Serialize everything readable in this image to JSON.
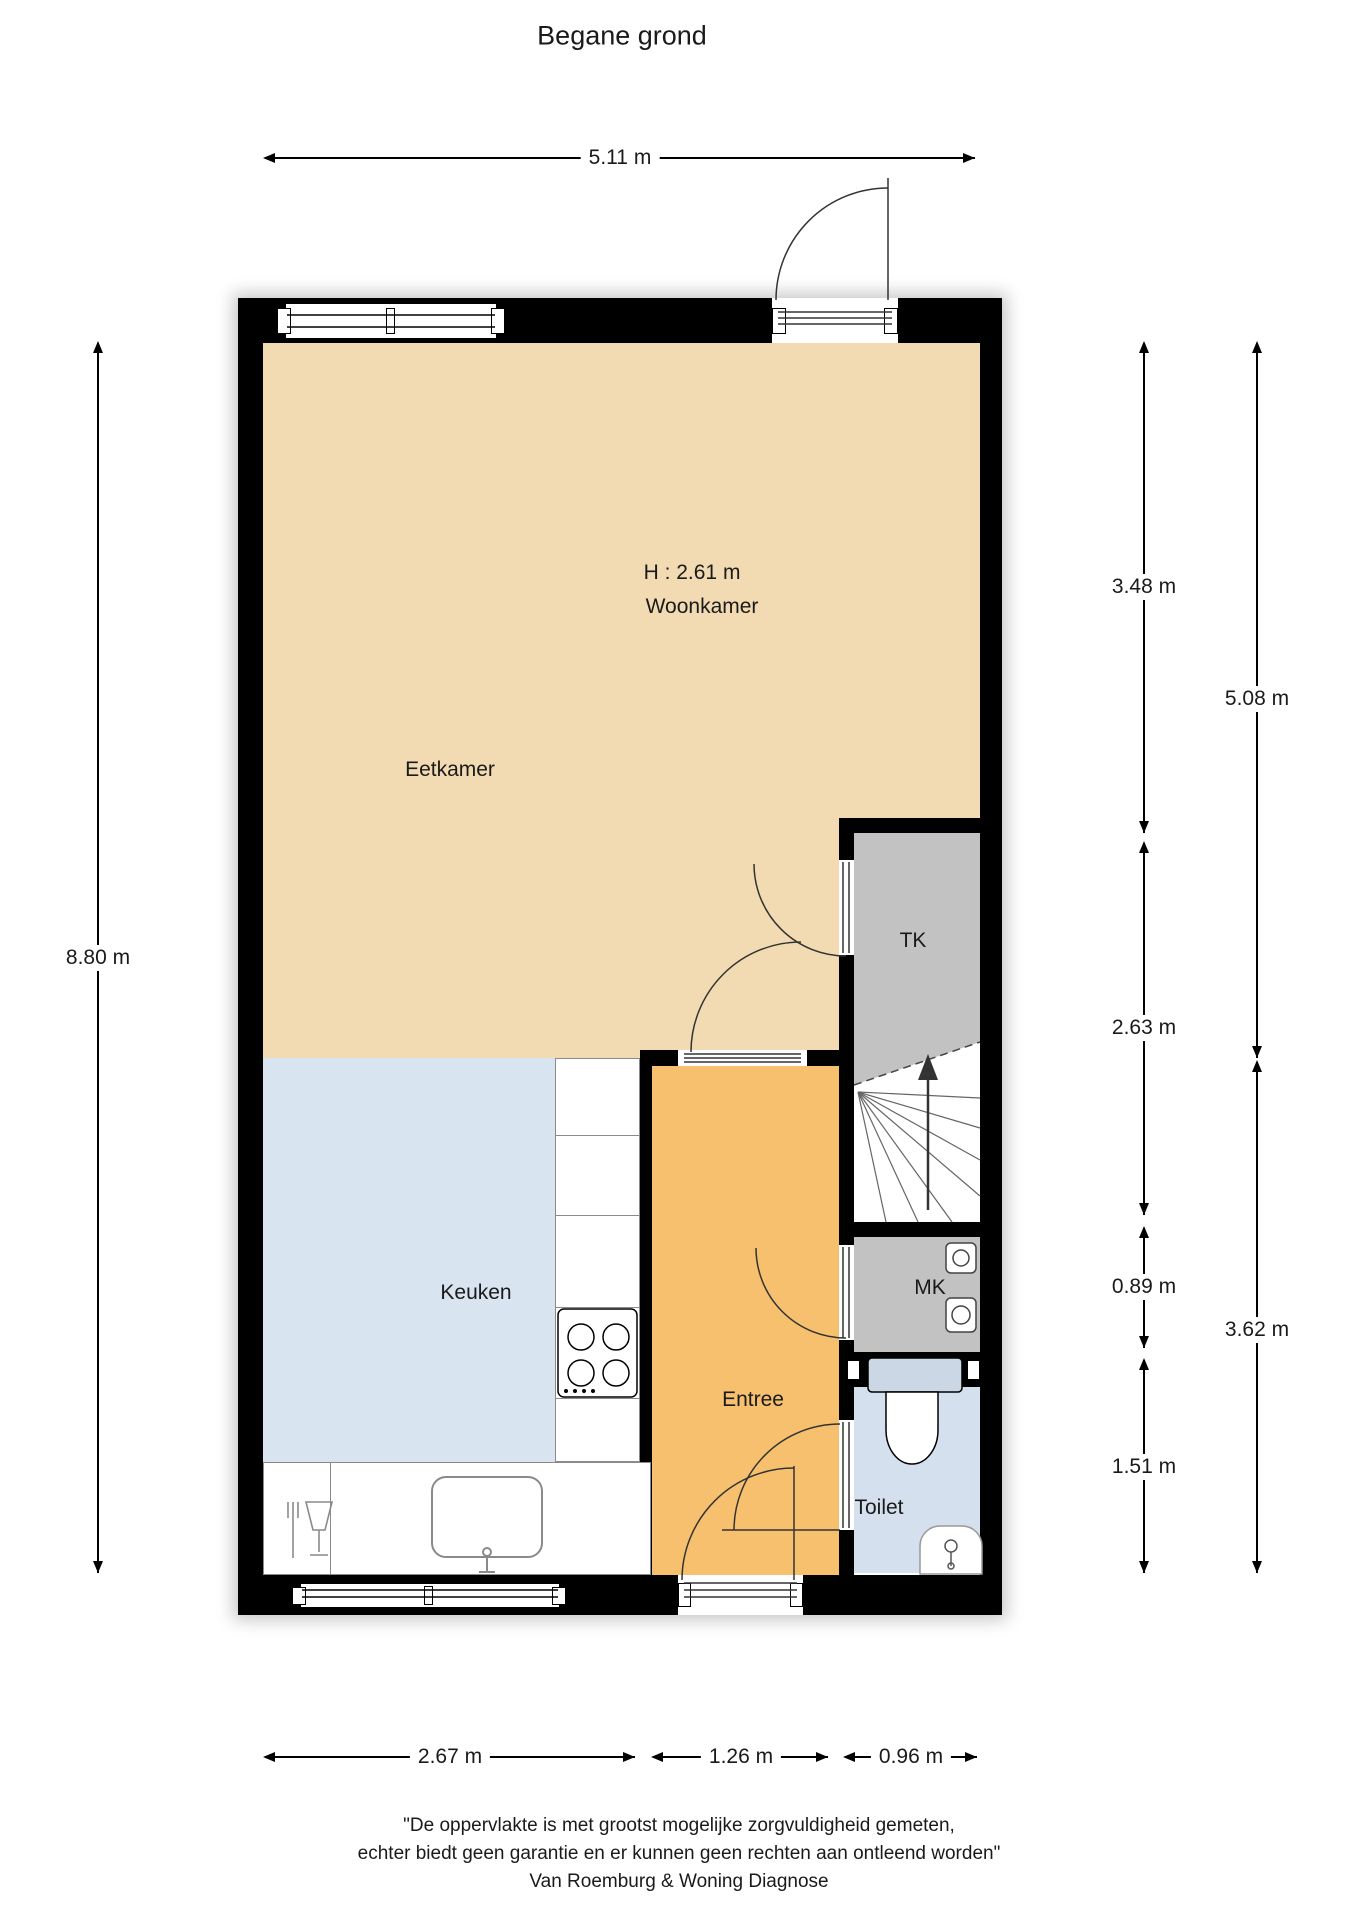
{
  "title": "Begane grond",
  "colors": {
    "wall": "#000000",
    "livingFloor": "#f2dbb2",
    "kitchenFloor": "#d9e4f1",
    "entreeFloor": "#f6c06e",
    "closetFloor": "#c2c2c2",
    "toiletFloor": "#d4e0ee",
    "cisternFill": "#ccd7e5"
  },
  "rooms": {
    "eetkamer": "Eetkamer",
    "woonkamer": "Woonkamer",
    "woonkamerHeight": "H : 2.61 m",
    "keuken": "Keuken",
    "entree": "Entree",
    "tk": "TK",
    "mk": "MK",
    "toilet": "Toilet"
  },
  "dimensions": {
    "top": "5.11 m",
    "left": "8.80 m",
    "rightInner": [
      "3.48 m",
      "2.63 m",
      "0.89 m",
      "1.51 m"
    ],
    "rightOuter": [
      "5.08 m",
      "3.62 m"
    ],
    "bottom": [
      "2.67 m",
      "1.26 m",
      "0.96 m"
    ]
  },
  "footer": {
    "line1": "\"De oppervlakte is met grootst mogelijke zorgvuldigheid gemeten,",
    "line2": "echter biedt geen garantie en er kunnen geen rechten aan ontleend worden\"",
    "line3": "Van Roemburg & Woning Diagnose"
  }
}
